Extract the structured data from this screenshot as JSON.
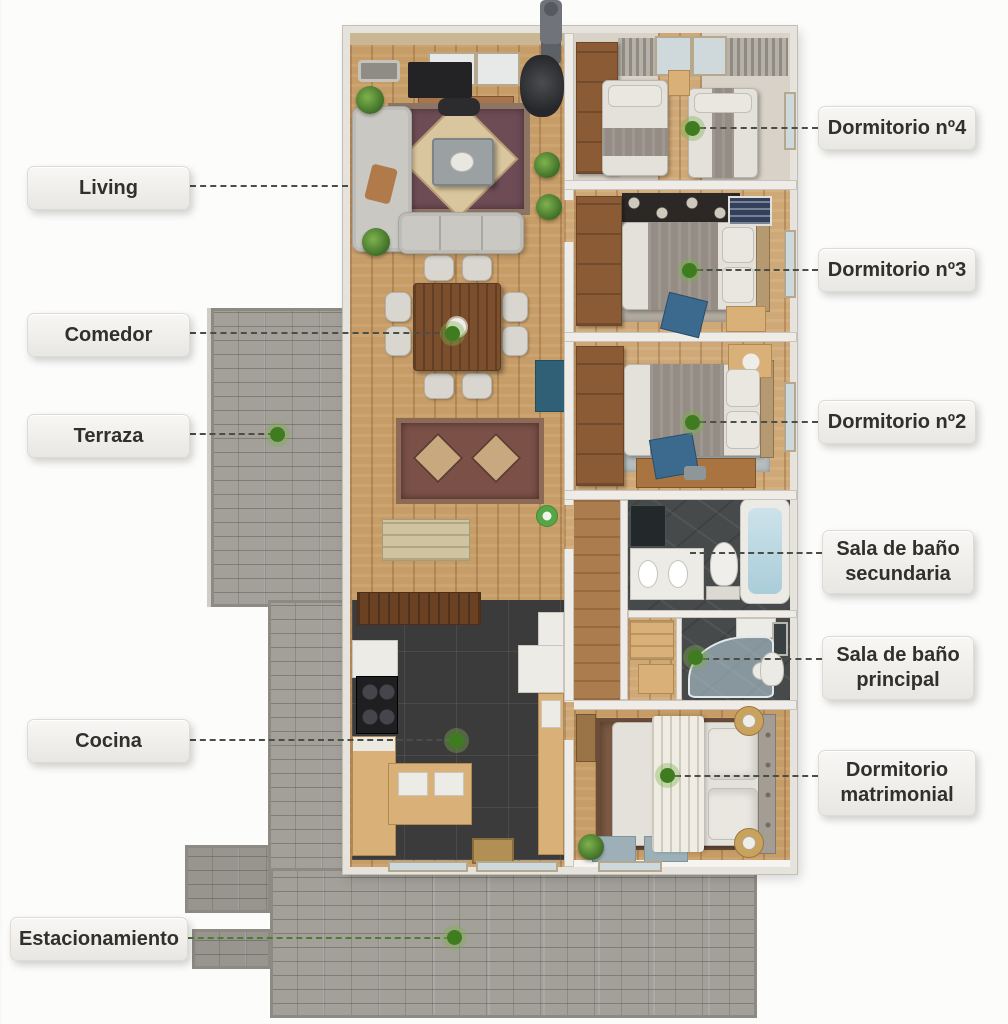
{
  "labels": [
    {
      "id": "living",
      "text": "Living"
    },
    {
      "id": "comedor",
      "text": "Comedor"
    },
    {
      "id": "terraza",
      "text": "Terraza"
    },
    {
      "id": "cocina",
      "text": "Cocina"
    },
    {
      "id": "estacionamiento",
      "text": "Estacionamiento"
    },
    {
      "id": "dormitorio-4",
      "text": "Dormitorio nº4"
    },
    {
      "id": "dormitorio-3",
      "text": "Dormitorio nº3"
    },
    {
      "id": "dormitorio-2",
      "text": "Dormitorio nº2"
    },
    {
      "id": "bano-secundaria",
      "text": "Sala de baño secundaria"
    },
    {
      "id": "bano-principal",
      "text": "Sala de baño principal"
    },
    {
      "id": "dormitorio-matrimonial",
      "text": "Dormitorio matrimonial"
    }
  ],
  "colors": {
    "label_background": "#f2f1ef",
    "label_text": "#31302d",
    "connector_dark": "#4b4e44",
    "connector_green": "#4e7d32",
    "marker_dot": "#3e7c1f",
    "marker_halo": "#7cb04c"
  }
}
